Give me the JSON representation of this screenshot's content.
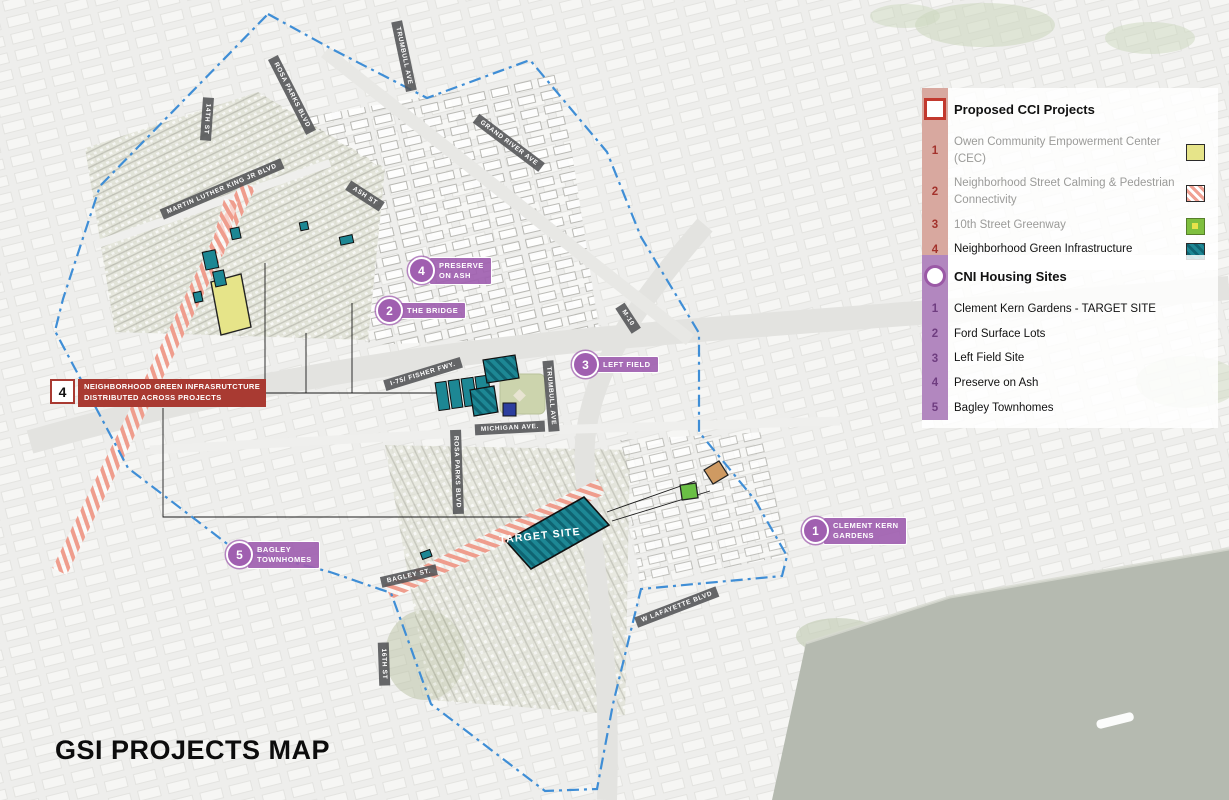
{
  "title": "GSI PROJECTS MAP",
  "legend_cci": {
    "header": "Proposed CCI Projects",
    "items": [
      {
        "num": "1",
        "label": "Owen Community Empowerment Center (CEC)"
      },
      {
        "num": "2",
        "label": "Neighborhood Street Calming & Pedestrian Connectivity"
      },
      {
        "num": "3",
        "label": "10th Street Greenway"
      },
      {
        "num": "4",
        "label": "Neighborhood Green Infrastructure"
      }
    ]
  },
  "legend_cni": {
    "header": "CNI Housing Sites",
    "items": [
      {
        "num": "1",
        "label": "Clement Kern Gardens - TARGET SITE"
      },
      {
        "num": "2",
        "label": "Ford Surface Lots"
      },
      {
        "num": "3",
        "label": "Left Field Site"
      },
      {
        "num": "4",
        "label": "Preserve on Ash"
      },
      {
        "num": "5",
        "label": "Bagley Townhomes"
      }
    ]
  },
  "badges": [
    {
      "num": "4",
      "line1": "PRESERVE",
      "line2": "ON ASH"
    },
    {
      "num": "2",
      "line1": "THE BRIDGE",
      "line2": ""
    },
    {
      "num": "3",
      "line1": "LEFT FIELD",
      "line2": ""
    },
    {
      "num": "1",
      "line1": "CLEMENT KERN",
      "line2": "GARDENS"
    },
    {
      "num": "5",
      "line1": "BAGLEY",
      "line2": "TOWNHOMES"
    }
  ],
  "red_callout": {
    "num": "4",
    "line1": "NEIGHBORHOOD GREEN INFRASRUTCTURE",
    "line2": "DISTRIBUTED ACROSS PROJECTS"
  },
  "target_site_label": "TARGET SITE",
  "streets": [
    {
      "name": "14TH ST"
    },
    {
      "name": "MARTIN LUTHER KING JR BLVD"
    },
    {
      "name": "ROSA PARKS BLVD"
    },
    {
      "name": "TRUMBULL AVE"
    },
    {
      "name": "GRAND RIVER AVE"
    },
    {
      "name": "ASH ST"
    },
    {
      "name": "I-75/ FISHER FWY."
    },
    {
      "name": "MICHIGAN AVE."
    },
    {
      "name": "ROSA PARKS BLVD"
    },
    {
      "name": "TRUMBULL AVE"
    },
    {
      "name": "M-10"
    },
    {
      "name": "BAGLEY ST."
    },
    {
      "name": "16TH ST"
    },
    {
      "name": "W LAFAYETTE BLVD"
    }
  ],
  "colors": {
    "cci_accent": "#a3322c",
    "cci_bar": "#d8a89f",
    "cni_accent": "#a05fb0",
    "boundary_blue": "#3f8ed6",
    "salmon_hatch": "#ef9d8d",
    "teal_site": "#1d8794",
    "cec_yellow": "#e6e489",
    "greenway_green": "#7fbf3f"
  }
}
